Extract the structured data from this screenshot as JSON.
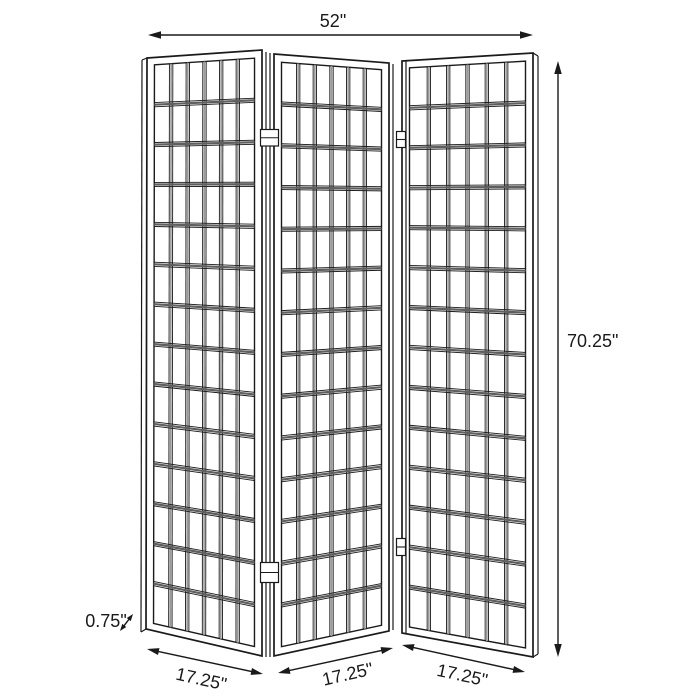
{
  "diagram": {
    "panel_count": 3,
    "grid_columns": 6,
    "grid_rows": 14
  },
  "dimensions": {
    "overall_width": "52\"",
    "overall_height": "70.25\"",
    "panel_thickness": "0.75\"",
    "panel_width_1": "17.25\"",
    "panel_width_2": "17.25\"",
    "panel_width_3": "17.25\""
  },
  "colors": {
    "line": "#1a1a1a",
    "rail_shadow": "#5f5f5f",
    "mullion_shadow": "#9a9a9a",
    "background": "#ffffff"
  }
}
